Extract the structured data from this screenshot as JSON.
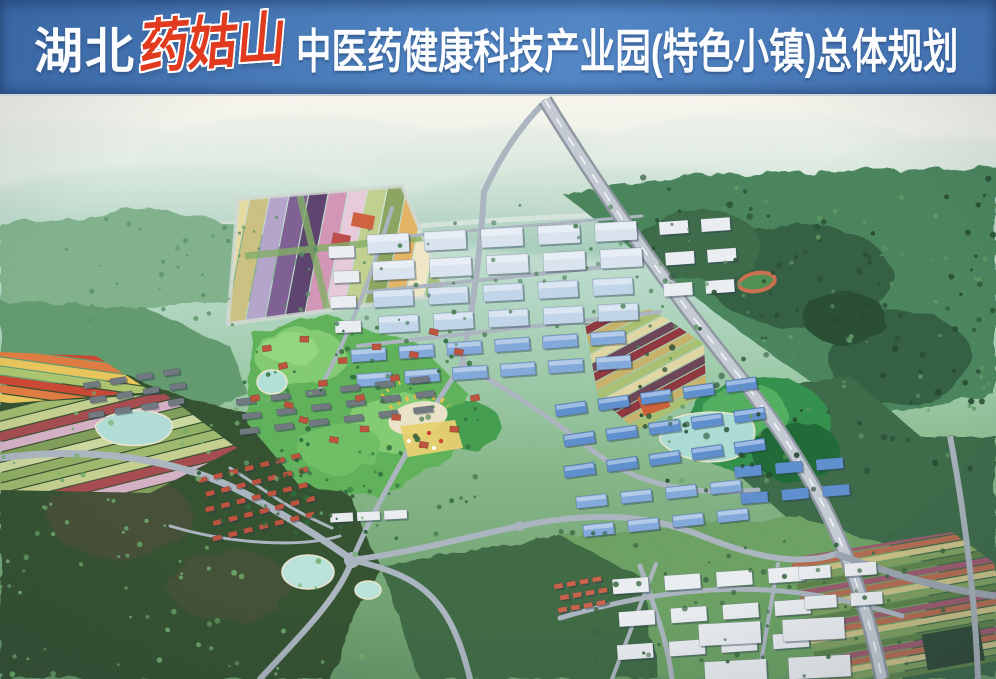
{
  "banner": {
    "prefix": "湖北",
    "brand": "药姑山",
    "title": "中医药健康科技产业园(特色小镇)总体规划",
    "colors": {
      "background": "#4a7cba",
      "background_dark": "#3a67a4",
      "text": "#fbfcfd",
      "brand_red": "#e23a1f"
    }
  },
  "scene": {
    "kind": "aerial-masterplan-rendering",
    "palette": {
      "haze": "#f2f1e9",
      "distant_hills": "#b9dccd",
      "forest_dark": "#30512f",
      "forest_mid": "#47855a",
      "park_green": "#5cb254",
      "road": "#aab4bf",
      "highway_base": "#8d97a2",
      "highway_deck": "#c3cad3",
      "water": "#aedcd5",
      "water_edge": "#e9e4cb",
      "factory_roof": "#d9e3ee",
      "factory_roof2": "#c0d4e9",
      "workshop_roof": "#5b8ed0",
      "workshop_roof2": "#7fa8dc",
      "white_bldg": "#e9edf0",
      "apartment": "#70787f",
      "villa_roof": "#c1513a",
      "red_small": "#cc6248",
      "field_yellow": "#e6db9e",
      "field_purple": "#7f5f96",
      "field_pink": "#d494b6",
      "flower_red": "#cf4630",
      "flower_orange": "#e2793c",
      "landmark_yellow": "#e8c23f",
      "track_lane": "#cb6d4c"
    }
  }
}
